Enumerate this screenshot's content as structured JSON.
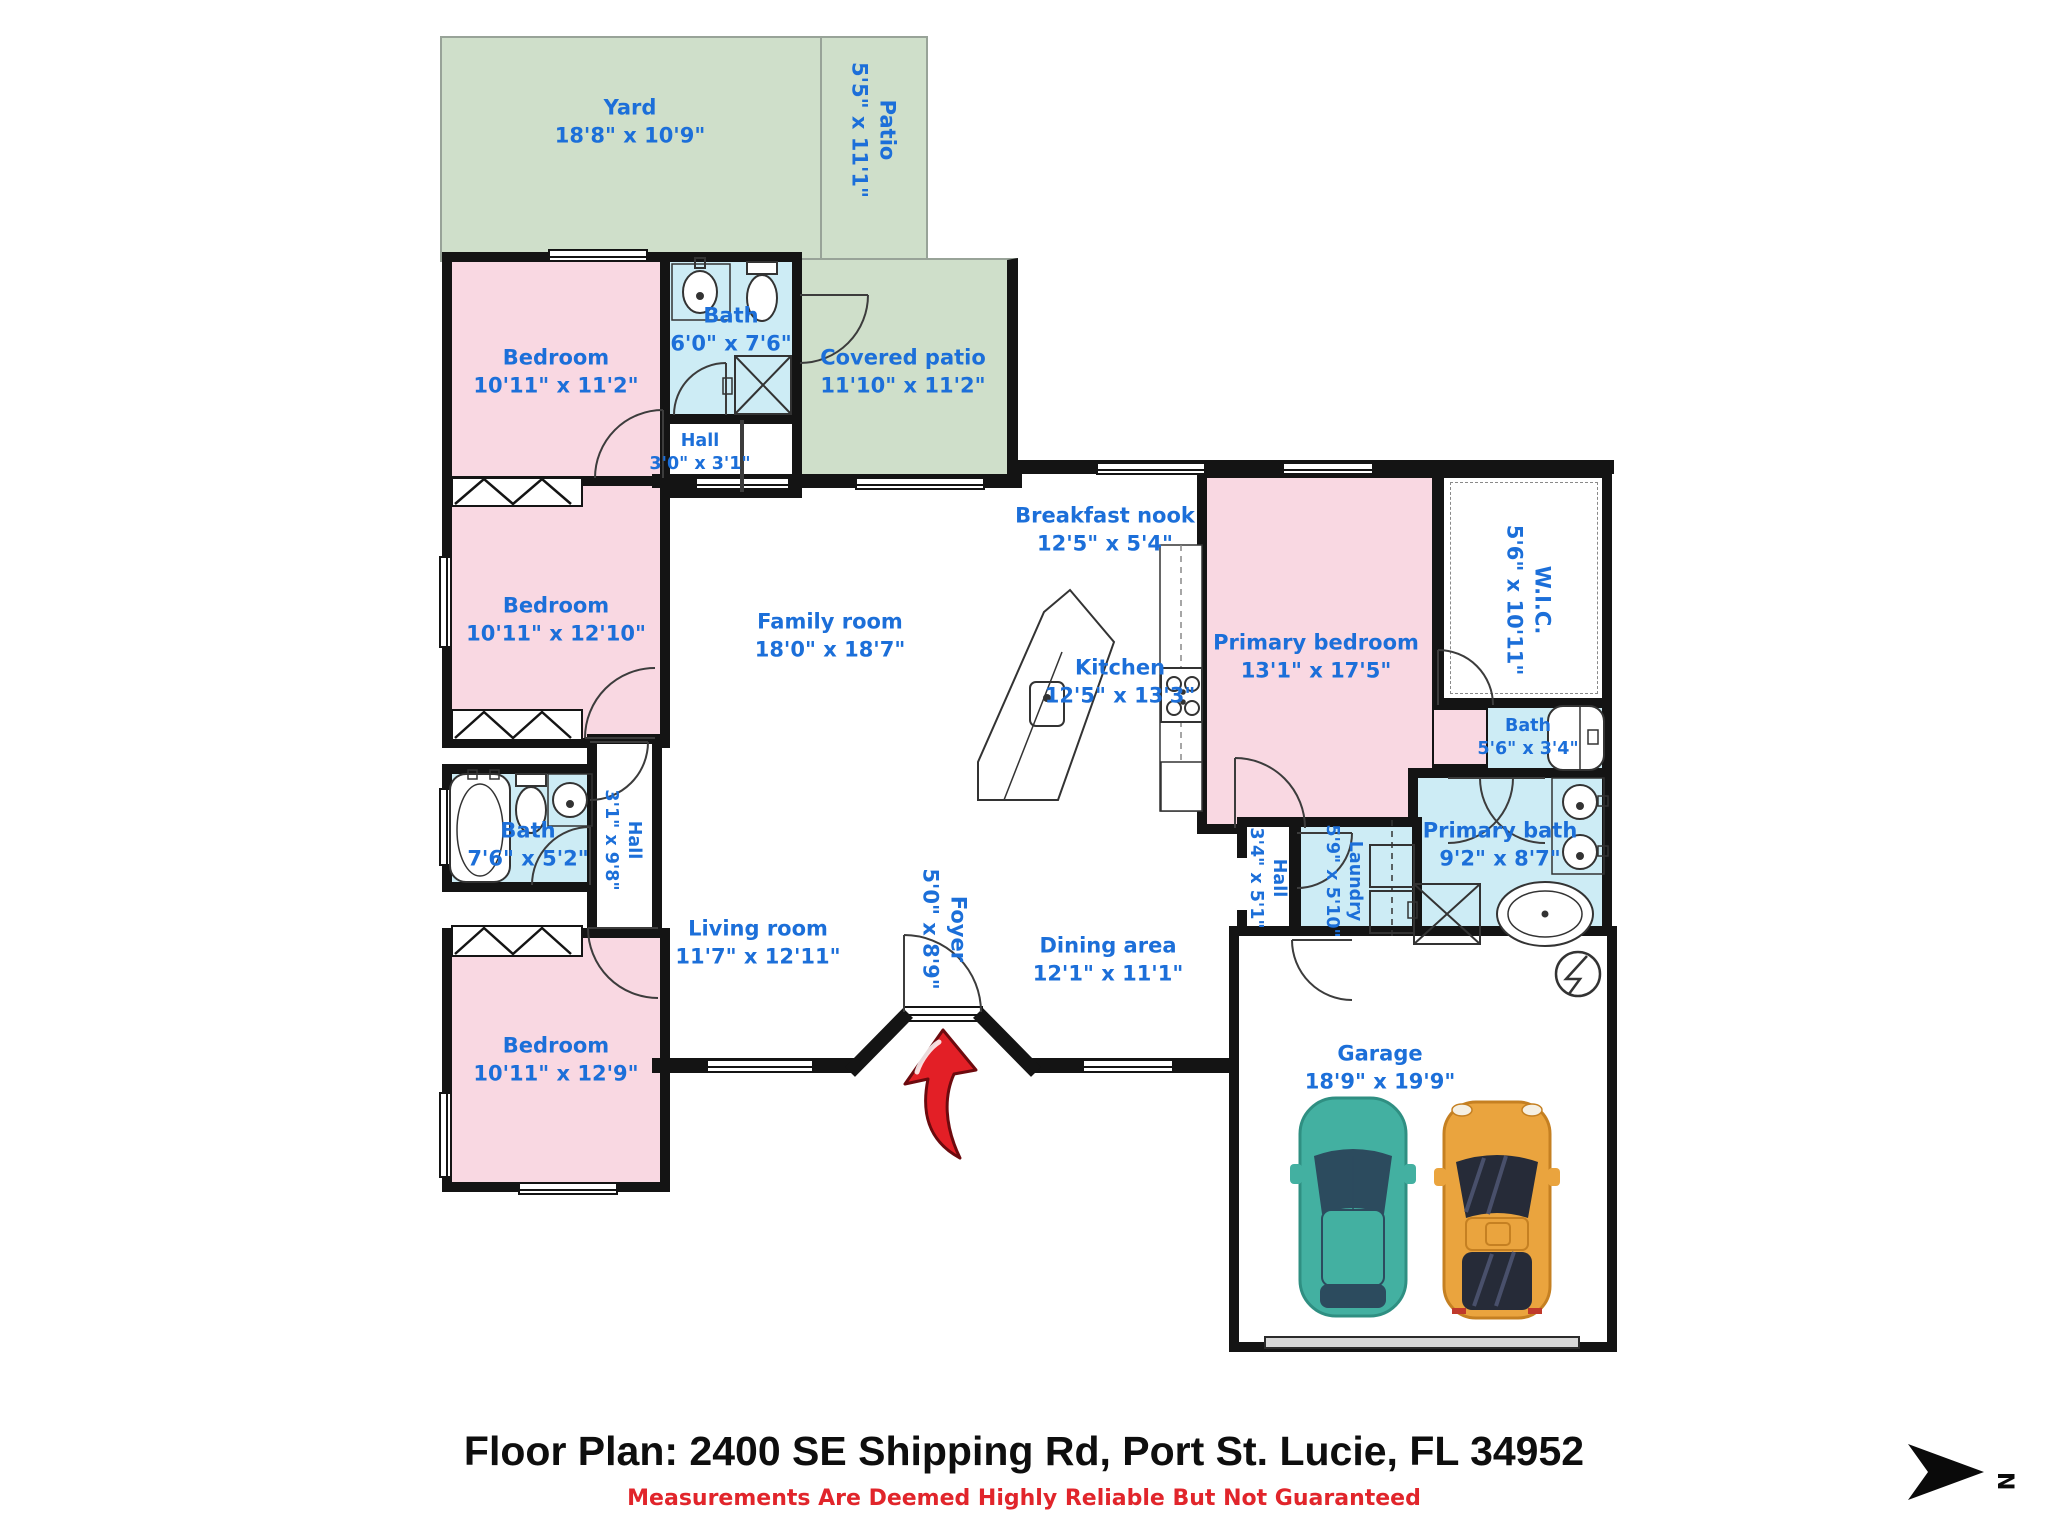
{
  "meta": {
    "title": "Floor Plan: 2400 SE Shipping Rd, Port St. Lucie, FL 34952",
    "disclaimer": "Measurements Are Deemed Highly Reliable But Not Guaranteed",
    "compass_label": "N"
  },
  "colors": {
    "label_blue": "#1c6fd9",
    "bedroom_pink": "#f9d8e2",
    "bath_blue": "#cdecf5",
    "outdoor_green": "#cfdfca",
    "wall_black": "#141414",
    "accent_red": "#e31f26",
    "car_teal": "#43b0a1",
    "car_orange": "#eaa43e"
  },
  "rooms": [
    {
      "id": "yard",
      "name": "Yard",
      "dims": "18'8\" x 10'9\""
    },
    {
      "id": "patio",
      "name": "Patio",
      "dims": "5'5\" x 11'1\""
    },
    {
      "id": "covered_patio",
      "name": "Covered patio",
      "dims": "11'10\" x 11'2\""
    },
    {
      "id": "bedroom_top",
      "name": "Bedroom",
      "dims": "10'11\" x 11'2\""
    },
    {
      "id": "bath_top",
      "name": "Bath",
      "dims": "6'0\" x 7'6\""
    },
    {
      "id": "hall_small",
      "name": "Hall",
      "dims": "3'0\" x 3'1\""
    },
    {
      "id": "bedroom_mid",
      "name": "Bedroom",
      "dims": "10'11\" x 12'10\""
    },
    {
      "id": "family_room",
      "name": "Family room",
      "dims": "18'0\" x 18'7\""
    },
    {
      "id": "breakfast_nook",
      "name": "Breakfast nook",
      "dims": "12'5\" x 5'4\""
    },
    {
      "id": "kitchen",
      "name": "Kitchen",
      "dims": "12'5\" x 13'3\""
    },
    {
      "id": "primary_bedroom",
      "name": "Primary bedroom",
      "dims": "13'1\" x 17'5\""
    },
    {
      "id": "wic",
      "name": "W.I.C.",
      "dims": "5'6\" x 10'11\""
    },
    {
      "id": "bath_right",
      "name": "Bath",
      "dims": "5'6\" x 3'4\""
    },
    {
      "id": "primary_bath",
      "name": "Primary bath",
      "dims": "9'2\" x 8'7\""
    },
    {
      "id": "bath_left",
      "name": "Bath",
      "dims": "7'6\" x 5'2\""
    },
    {
      "id": "hall_left",
      "name": "Hall",
      "dims": "3'1\" x 9'8\""
    },
    {
      "id": "hall_right",
      "name": "Hall",
      "dims": "3'4\" x 5'1\""
    },
    {
      "id": "laundry",
      "name": "Laundry",
      "dims": "5'9\" x 5'10\""
    },
    {
      "id": "living_room",
      "name": "Living room",
      "dims": "11'7\" x 12'11\""
    },
    {
      "id": "foyer",
      "name": "Foyer",
      "dims": "5'0\" x 8'9\""
    },
    {
      "id": "dining_area",
      "name": "Dining area",
      "dims": "12'1\" x 11'1\""
    },
    {
      "id": "bedroom_bottom",
      "name": "Bedroom",
      "dims": "10'11\" x 12'9\""
    },
    {
      "id": "garage",
      "name": "Garage",
      "dims": "18'9\" x 19'9\""
    }
  ]
}
